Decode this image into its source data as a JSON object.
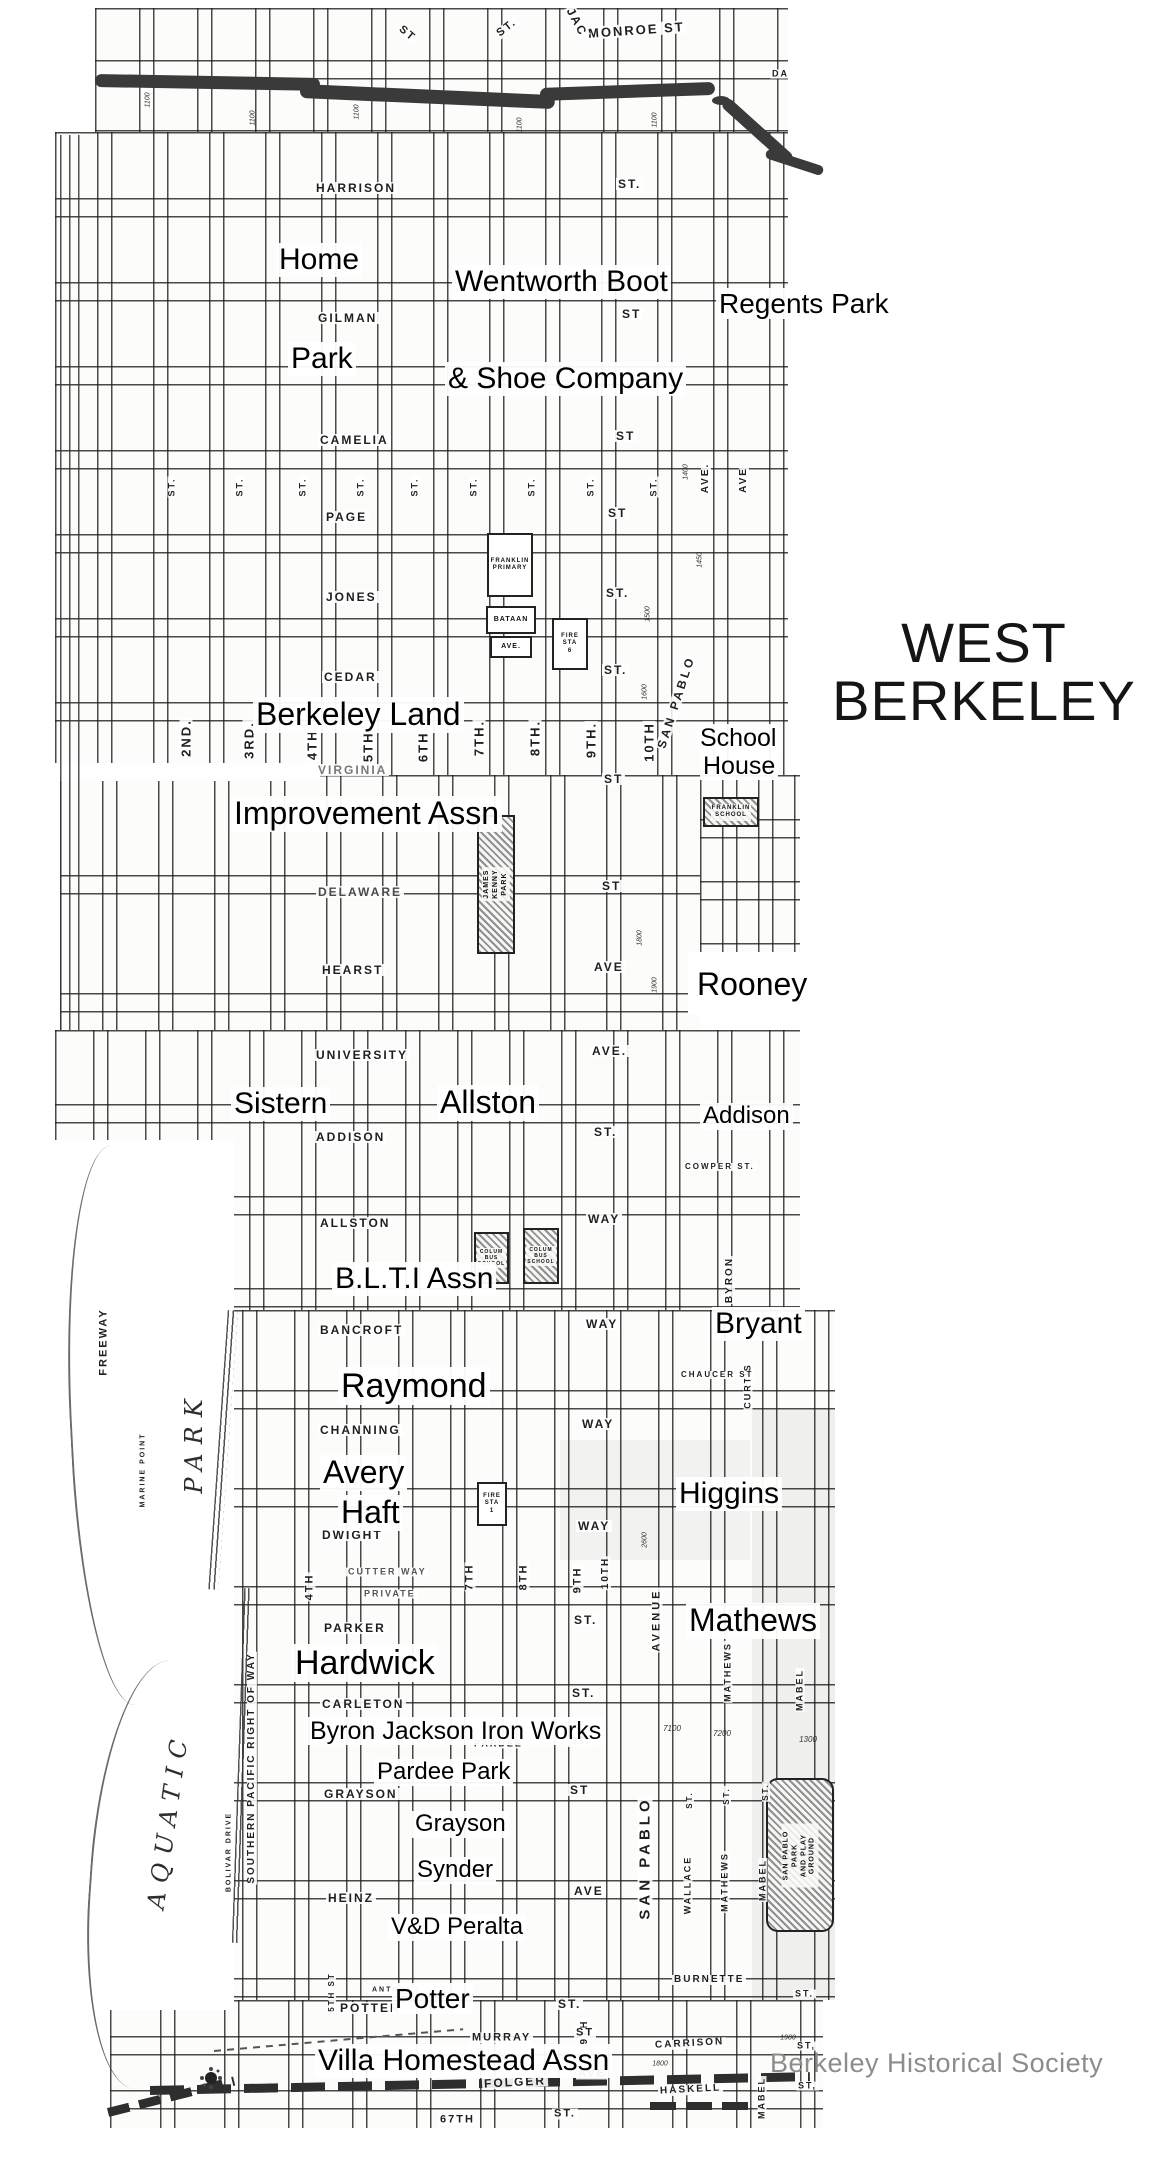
{
  "title": {
    "line1": "WEST",
    "line2": "BERKELEY"
  },
  "credit": "Berkeley Historical Society",
  "colors": {
    "ink": "#1c1c1c",
    "annotation": "#000000",
    "credit_gray": "#8c8c8c",
    "railroad": "#3a3a3a",
    "paper": "#fbfbf8"
  },
  "annotations": [
    {
      "text": "Home",
      "x": 276,
      "y": 243,
      "fs": 30
    },
    {
      "text": "Wentworth Boot",
      "x": 452,
      "y": 265,
      "fs": 30
    },
    {
      "text": "Regents Park",
      "x": 716,
      "y": 288,
      "fs": 28
    },
    {
      "text": "Park",
      "x": 288,
      "y": 342,
      "fs": 30
    },
    {
      "text": "& Shoe Company",
      "x": 445,
      "y": 362,
      "fs": 30
    },
    {
      "text": "Berkeley Land",
      "x": 253,
      "y": 697,
      "fs": 32
    },
    {
      "text": "School",
      "x": 697,
      "y": 724,
      "fs": 25
    },
    {
      "text": "House",
      "x": 700,
      "y": 752,
      "fs": 25
    },
    {
      "text": "Improvement Assn",
      "x": 231,
      "y": 796,
      "fs": 32
    },
    {
      "text": "Rooney",
      "x": 694,
      "y": 967,
      "fs": 32
    },
    {
      "text": "Sistern",
      "x": 231,
      "y": 1087,
      "fs": 30
    },
    {
      "text": "Allston",
      "x": 437,
      "y": 1085,
      "fs": 32
    },
    {
      "text": "Addison",
      "x": 700,
      "y": 1103,
      "fs": 24
    },
    {
      "text": "B.L.T.I Assn",
      "x": 332,
      "y": 1262,
      "fs": 30
    },
    {
      "text": "Bryant",
      "x": 712,
      "y": 1307,
      "fs": 30
    },
    {
      "text": "Raymond",
      "x": 338,
      "y": 1367,
      "fs": 34
    },
    {
      "text": "Avery",
      "x": 320,
      "y": 1455,
      "fs": 32
    },
    {
      "text": "Haft",
      "x": 338,
      "y": 1495,
      "fs": 32
    },
    {
      "text": "Higgins",
      "x": 676,
      "y": 1477,
      "fs": 30
    },
    {
      "text": "Mathews",
      "x": 686,
      "y": 1603,
      "fs": 32
    },
    {
      "text": "Hardwick",
      "x": 292,
      "y": 1644,
      "fs": 34
    },
    {
      "text": "Byron Jackson Iron Works",
      "x": 307,
      "y": 1717,
      "fs": 25
    },
    {
      "text": "Pardee Park",
      "x": 374,
      "y": 1759,
      "fs": 24
    },
    {
      "text": "Grayson",
      "x": 412,
      "y": 1811,
      "fs": 24
    },
    {
      "text": "Synder",
      "x": 414,
      "y": 1857,
      "fs": 24
    },
    {
      "text": "V&D Peralta",
      "x": 388,
      "y": 1914,
      "fs": 24
    },
    {
      "text": "Potter",
      "x": 392,
      "y": 1983,
      "fs": 28
    },
    {
      "text": "Villa Homestead Assn",
      "x": 315,
      "y": 2044,
      "fs": 30
    }
  ],
  "street_labels": [
    {
      "t": "MONROE ST",
      "x": 586,
      "y": 30,
      "fs": 13,
      "rot": -4
    },
    {
      "t": "JAC",
      "x": 560,
      "y": 22,
      "fs": 12,
      "rot": 62
    },
    {
      "t": "ST",
      "x": 396,
      "y": 34,
      "fs": 11,
      "rot": 40
    },
    {
      "t": "ST.",
      "x": 494,
      "y": 28,
      "fs": 11,
      "rot": -38
    },
    {
      "t": "DA",
      "x": 770,
      "y": 74,
      "fs": 9
    },
    {
      "t": "HARRISON",
      "x": 314,
      "y": 188,
      "fs": 12
    },
    {
      "t": "ST.",
      "x": 616,
      "y": 184,
      "fs": 12
    },
    {
      "t": "GILMAN",
      "x": 316,
      "y": 318,
      "fs": 12
    },
    {
      "t": "ST",
      "x": 620,
      "y": 314,
      "fs": 12
    },
    {
      "t": "CAMELIA",
      "x": 318,
      "y": 440,
      "fs": 12
    },
    {
      "t": "ST",
      "x": 614,
      "y": 436,
      "fs": 12
    },
    {
      "t": "PAGE",
      "x": 324,
      "y": 517,
      "fs": 12
    },
    {
      "t": "ST",
      "x": 606,
      "y": 513,
      "fs": 12
    },
    {
      "t": "JONES",
      "x": 324,
      "y": 597,
      "fs": 12
    },
    {
      "t": "ST.",
      "x": 604,
      "y": 593,
      "fs": 12
    },
    {
      "t": "CEDAR",
      "x": 322,
      "y": 677,
      "fs": 12
    },
    {
      "t": "ST.",
      "x": 602,
      "y": 670,
      "fs": 12
    },
    {
      "t": "VIRGINIA",
      "x": 316,
      "y": 770,
      "fs": 12,
      "c": "#787878"
    },
    {
      "t": "ST",
      "x": 602,
      "y": 779,
      "fs": 12
    },
    {
      "t": "DELAWARE",
      "x": 316,
      "y": 892,
      "fs": 12,
      "c": "#4a4a4a"
    },
    {
      "t": "ST",
      "x": 600,
      "y": 886,
      "fs": 12
    },
    {
      "t": "HEARST",
      "x": 320,
      "y": 970,
      "fs": 12
    },
    {
      "t": "AVE",
      "x": 592,
      "y": 967,
      "fs": 12
    },
    {
      "t": "UNIVERSITY",
      "x": 314,
      "y": 1055,
      "fs": 12
    },
    {
      "t": "AVE.",
      "x": 590,
      "y": 1051,
      "fs": 12
    },
    {
      "t": "ADDISON",
      "x": 314,
      "y": 1137,
      "fs": 12
    },
    {
      "t": "ST.",
      "x": 592,
      "y": 1132,
      "fs": 12
    },
    {
      "t": "ALLSTON",
      "x": 318,
      "y": 1223,
      "fs": 12
    },
    {
      "t": "WAY",
      "x": 586,
      "y": 1219,
      "fs": 12
    },
    {
      "t": "BANCROFT",
      "x": 318,
      "y": 1330,
      "fs": 12
    },
    {
      "t": "WAY",
      "x": 584,
      "y": 1324,
      "fs": 12
    },
    {
      "t": "CHANNING",
      "x": 318,
      "y": 1430,
      "fs": 12
    },
    {
      "t": "WAY",
      "x": 580,
      "y": 1424,
      "fs": 12
    },
    {
      "t": "DWIGHT",
      "x": 320,
      "y": 1535,
      "fs": 12
    },
    {
      "t": "WAY",
      "x": 576,
      "y": 1526,
      "fs": 12
    },
    {
      "t": "CUTTER WAY",
      "x": 346,
      "y": 1572,
      "fs": 9,
      "c": "#555555"
    },
    {
      "t": "PRIVATE",
      "x": 362,
      "y": 1594,
      "fs": 9,
      "c": "#555555"
    },
    {
      "t": "PARKER",
      "x": 322,
      "y": 1628,
      "fs": 12
    },
    {
      "t": "ST.",
      "x": 572,
      "y": 1620,
      "fs": 12
    },
    {
      "t": "CARLETON",
      "x": 320,
      "y": 1704,
      "fs": 12
    },
    {
      "t": "ST.",
      "x": 570,
      "y": 1693,
      "fs": 12
    },
    {
      "t": "PARDEE",
      "x": 472,
      "y": 1744,
      "fs": 9
    },
    {
      "t": "ST.",
      "x": 568,
      "y": 1742,
      "fs": 10
    },
    {
      "t": "GRAYSON",
      "x": 322,
      "y": 1794,
      "fs": 12
    },
    {
      "t": "ST",
      "x": 568,
      "y": 1790,
      "fs": 12
    },
    {
      "t": "HEINZ",
      "x": 326,
      "y": 1898,
      "fs": 12
    },
    {
      "t": "AVE",
      "x": 572,
      "y": 1891,
      "fs": 12
    },
    {
      "t": "ANTHONY",
      "x": 370,
      "y": 1990,
      "fs": 7
    },
    {
      "t": "POTTER",
      "x": 338,
      "y": 2008,
      "fs": 12
    },
    {
      "t": "ST.",
      "x": 556,
      "y": 2004,
      "fs": 12
    },
    {
      "t": "MURRAY",
      "x": 470,
      "y": 2038,
      "fs": 11
    },
    {
      "t": "ST",
      "x": 574,
      "y": 2033,
      "fs": 11
    },
    {
      "t": "AVE.",
      "x": 478,
      "y": 2058,
      "fs": 9
    },
    {
      "t": "FOLGER",
      "x": 482,
      "y": 2082,
      "fs": 12,
      "rot": -3
    },
    {
      "t": "AVE",
      "x": 576,
      "y": 2074,
      "fs": 11
    },
    {
      "t": "67TH",
      "x": 438,
      "y": 2120,
      "fs": 11
    },
    {
      "t": "ST.",
      "x": 552,
      "y": 2114,
      "fs": 11
    },
    {
      "t": "BURNETTE",
      "x": 672,
      "y": 1980,
      "fs": 10
    },
    {
      "t": "ST.",
      "x": 793,
      "y": 1994,
      "fs": 9
    },
    {
      "t": "CARRISON",
      "x": 653,
      "y": 2044,
      "fs": 10,
      "rot": -3
    },
    {
      "t": "ST,",
      "x": 795,
      "y": 2046,
      "fs": 9
    },
    {
      "t": "HASKELL",
      "x": 658,
      "y": 2090,
      "fs": 10,
      "rot": -3
    },
    {
      "t": "ST,",
      "x": 796,
      "y": 2086,
      "fs": 9
    },
    {
      "t": "CHAUCER ST",
      "x": 679,
      "y": 1375,
      "fs": 8
    },
    {
      "t": "COWPER ST.",
      "x": 683,
      "y": 1167,
      "fs": 8
    }
  ],
  "street_labels_vertical": [
    {
      "t": "2ND.",
      "x": 186,
      "y": 738,
      "fs": 13
    },
    {
      "t": "3RD.",
      "x": 249,
      "y": 740,
      "fs": 13
    },
    {
      "t": "4TH.",
      "x": 312,
      "y": 742,
      "fs": 13
    },
    {
      "t": "5TH.",
      "x": 368,
      "y": 744,
      "fs": 13
    },
    {
      "t": "6TH.",
      "x": 423,
      "y": 744,
      "fs": 13
    },
    {
      "t": "7TH.",
      "x": 479,
      "y": 738,
      "fs": 13
    },
    {
      "t": "8TH.",
      "x": 535,
      "y": 738,
      "fs": 13
    },
    {
      "t": "9TH.",
      "x": 591,
      "y": 740,
      "fs": 13
    },
    {
      "t": "10TH",
      "x": 649,
      "y": 742,
      "fs": 13
    },
    {
      "t": "SAN PABLO",
      "x": 676,
      "y": 702,
      "fs": 12,
      "rot": -72,
      "ls": 3
    },
    {
      "t": "ST.",
      "x": 172,
      "y": 487,
      "fs": 9
    },
    {
      "t": "ST.",
      "x": 240,
      "y": 487,
      "fs": 9
    },
    {
      "t": "ST.",
      "x": 303,
      "y": 487,
      "fs": 9
    },
    {
      "t": "ST.",
      "x": 361,
      "y": 487,
      "fs": 9
    },
    {
      "t": "ST.",
      "x": 415,
      "y": 487,
      "fs": 9
    },
    {
      "t": "ST.",
      "x": 474,
      "y": 487,
      "fs": 9
    },
    {
      "t": "ST.",
      "x": 532,
      "y": 487,
      "fs": 9
    },
    {
      "t": "ST.",
      "x": 591,
      "y": 487,
      "fs": 9
    },
    {
      "t": "ST.",
      "x": 654,
      "y": 487,
      "fs": 9
    },
    {
      "t": "AVE.",
      "x": 706,
      "y": 478,
      "fs": 10
    },
    {
      "t": "AVE",
      "x": 744,
      "y": 480,
      "fs": 10
    },
    {
      "t": "4TH",
      "x": 310,
      "y": 1587,
      "fs": 11
    },
    {
      "t": "7TH",
      "x": 470,
      "y": 1577,
      "fs": 11
    },
    {
      "t": "8TH",
      "x": 524,
      "y": 1577,
      "fs": 11
    },
    {
      "t": "9TH",
      "x": 578,
      "y": 1580,
      "fs": 11
    },
    {
      "t": "10TH",
      "x": 606,
      "y": 1573,
      "fs": 10
    },
    {
      "t": "5TH ST",
      "x": 332,
      "y": 1992,
      "fs": 8
    },
    {
      "t": "9TH",
      "x": 585,
      "y": 2032,
      "fs": 10
    },
    {
      "t": "BYRON",
      "x": 730,
      "y": 1280,
      "fs": 10
    },
    {
      "t": "CURTIS",
      "x": 748,
      "y": 1386,
      "fs": 9
    },
    {
      "t": "AVENUE",
      "x": 657,
      "y": 1620,
      "fs": 11,
      "ls": 3
    },
    {
      "t": "MATHEWS",
      "x": 728,
      "y": 1672,
      "fs": 9
    },
    {
      "t": "MABEL",
      "x": 800,
      "y": 1690,
      "fs": 9
    },
    {
      "t": "SAN PABLO",
      "x": 645,
      "y": 1858,
      "fs": 15,
      "ls": 4
    },
    {
      "t": "WALLACE",
      "x": 688,
      "y": 1885,
      "fs": 9
    },
    {
      "t": "MATHEWS",
      "x": 725,
      "y": 1882,
      "fs": 9
    },
    {
      "t": "MABEL",
      "x": 763,
      "y": 1880,
      "fs": 9
    },
    {
      "t": "ST.",
      "x": 690,
      "y": 1800,
      "fs": 8
    },
    {
      "t": "ST.",
      "x": 727,
      "y": 1796,
      "fs": 8
    },
    {
      "t": "ST.",
      "x": 766,
      "y": 1792,
      "fs": 8
    },
    {
      "t": "MABEL",
      "x": 762,
      "y": 2098,
      "fs": 9
    },
    {
      "t": "SOUTHERN PACIFIC RIGHT OF WAY",
      "x": 252,
      "y": 1768,
      "fs": 10,
      "ls": 2
    },
    {
      "t": "FREEWAY",
      "x": 104,
      "y": 1342,
      "fs": 11,
      "ls": 2
    },
    {
      "t": "PARK",
      "x": 194,
      "y": 1442,
      "fs": 24,
      "serif": true,
      "ls": 9
    },
    {
      "t": "AQUATIC",
      "x": 168,
      "y": 1820,
      "fs": 24,
      "serif": true,
      "ls": 9,
      "rot": -82
    },
    {
      "t": "MARINE POINT",
      "x": 143,
      "y": 1470,
      "fs": 7
    },
    {
      "t": "BOLIVAR DRIVE",
      "x": 229,
      "y": 1852,
      "fs": 7
    }
  ],
  "block_numbers": [
    {
      "t": "1100",
      "x": 148,
      "y": 100
    },
    {
      "t": "1100",
      "x": 253,
      "y": 118
    },
    {
      "t": "1100",
      "x": 357,
      "y": 112
    },
    {
      "t": "1100",
      "x": 520,
      "y": 125
    },
    {
      "t": "1100",
      "x": 655,
      "y": 120
    },
    {
      "t": "1400",
      "x": 686,
      "y": 472
    },
    {
      "t": "1450",
      "x": 700,
      "y": 560
    },
    {
      "t": "1500",
      "x": 648,
      "y": 614
    },
    {
      "t": "1600",
      "x": 645,
      "y": 692
    },
    {
      "t": "1800",
      "x": 640,
      "y": 938
    },
    {
      "t": "1900",
      "x": 655,
      "y": 985
    },
    {
      "t": "2600",
      "x": 645,
      "y": 1540
    },
    {
      "t": "7100",
      "x": 672,
      "y": 1729,
      "rot": 0,
      "fs": 8
    },
    {
      "t": "7200",
      "x": 722,
      "y": 1734,
      "rot": 0,
      "fs": 8
    },
    {
      "t": "1300",
      "x": 808,
      "y": 1740,
      "rot": 0,
      "fs": 8
    },
    {
      "t": "1000",
      "x": 488,
      "y": 2070,
      "rot": 0
    },
    {
      "t": "1800",
      "x": 660,
      "y": 2064,
      "rot": 0
    },
    {
      "t": "1900",
      "x": 788,
      "y": 2038,
      "rot": 0
    }
  ],
  "features": [
    {
      "name": "james-kenny-park",
      "x": 477,
      "y": 815,
      "w": 34,
      "h": 135,
      "hatch": true,
      "label": "JAMES KENNY PARK",
      "lfs": 7,
      "vert": true
    },
    {
      "name": "franklin-school",
      "x": 703,
      "y": 797,
      "w": 52,
      "h": 26,
      "hatch": true,
      "label": "FRANKLIN\nSCHOOL",
      "lfs": 6
    },
    {
      "name": "franklin-primary",
      "x": 487,
      "y": 533,
      "w": 42,
      "h": 60,
      "label": "FRANKLIN\nPRIMARY",
      "lfs": 6
    },
    {
      "name": "bataan-block",
      "x": 486,
      "y": 606,
      "w": 46,
      "h": 24,
      "label": "BATAAN",
      "lfs": 7
    },
    {
      "name": "ave-block",
      "x": 490,
      "y": 636,
      "w": 38,
      "h": 18,
      "label": "AVE.",
      "lfs": 7
    },
    {
      "name": "fire-station-6",
      "x": 552,
      "y": 618,
      "w": 32,
      "h": 48,
      "label": "FIRE\nSTA\n6",
      "lfs": 6
    },
    {
      "name": "fire-station-1",
      "x": 477,
      "y": 1482,
      "w": 26,
      "h": 40,
      "label": "FIRE\nSTA\n1",
      "lfs": 6
    },
    {
      "name": "columbus-school-1",
      "x": 474,
      "y": 1232,
      "w": 31,
      "h": 48,
      "hatch": true,
      "label": "COLUM\nBUS\nSCHOOL",
      "lfs": 5
    },
    {
      "name": "columbus-school-2",
      "x": 523,
      "y": 1228,
      "w": 32,
      "h": 52,
      "hatch": true,
      "label": "COLUM\nBUS\nSCHOOL",
      "lfs": 5
    },
    {
      "name": "san-pablo-park",
      "x": 766,
      "y": 1778,
      "w": 64,
      "h": 150,
      "hatch": true,
      "round": 12,
      "label": "SAN PABLO PARK\nAND PLAY GROUND",
      "lfs": 7,
      "vert": true
    }
  ],
  "map_pieces": [
    {
      "x": 95,
      "y": 8,
      "w": 693,
      "h": 124,
      "cols": 58,
      "rows": 70
    },
    {
      "x": 55,
      "y": 132,
      "w": 733,
      "h": 643,
      "cols": 56,
      "rows": 84
    },
    {
      "x": 60,
      "y": 775,
      "w": 640,
      "h": 255,
      "cols": 56,
      "rows": 118
    },
    {
      "x": 700,
      "y": 775,
      "w": 100,
      "h": 180,
      "cols": 36,
      "rows": 62
    },
    {
      "x": 55,
      "y": 1030,
      "w": 745,
      "h": 280,
      "cols": 52,
      "rows": 92
    },
    {
      "x": 48,
      "y": 1310,
      "w": 787,
      "h": 690,
      "cols": 52,
      "rows": 98
    },
    {
      "x": 110,
      "y": 2000,
      "w": 713,
      "h": 128,
      "cols": 64,
      "rows": 54
    }
  ],
  "white_regions": [
    {
      "x": 48,
      "y": 1140,
      "w": 186,
      "h": 870
    },
    {
      "x": 55,
      "y": 763,
      "w": 265,
      "h": 18
    },
    {
      "x": 688,
      "y": 952,
      "w": 140,
      "h": 62
    }
  ],
  "shades": [
    {
      "x": 752,
      "y": 1410,
      "w": 83,
      "h": 590,
      "o": 0.05
    },
    {
      "x": 560,
      "y": 1440,
      "w": 190,
      "h": 120,
      "o": 0.04
    },
    {
      "x": 120,
      "y": 1660,
      "w": 110,
      "h": 340,
      "o": 0.04
    }
  ],
  "curves": [
    {
      "x": 70,
      "y": 1145,
      "w": 110,
      "h": 560,
      "rot": -3
    },
    {
      "x": 90,
      "y": 1660,
      "w": 130,
      "h": 430,
      "rot": 4
    }
  ],
  "multilines": [
    {
      "x": 60,
      "y": 135,
      "w": 25,
      "h": 895,
      "gap": 9,
      "rot": 0
    },
    {
      "x": 238,
      "y": 1588,
      "w": 7,
      "h": 355,
      "gap": 4,
      "rot": 2
    },
    {
      "x": 218,
      "y": 1310,
      "w": 10,
      "h": 280,
      "gap": 5,
      "rot": 4
    }
  ],
  "railroad_segments": [
    {
      "x": 95,
      "y": 74,
      "w": 225,
      "h": 13,
      "rot": 1
    },
    {
      "x": 300,
      "y": 84,
      "w": 255,
      "h": 14,
      "rot": 2.5
    },
    {
      "x": 540,
      "y": 88,
      "w": 175,
      "h": 13,
      "rot": -2
    },
    {
      "x": 724,
      "y": 95,
      "w": 90,
      "h": 12,
      "rot": 42
    },
    {
      "x": 766,
      "y": 148,
      "w": 60,
      "h": 10,
      "rot": 18
    }
  ],
  "railroad_dot": {
    "x": 712,
    "y": 96,
    "r": 9
  },
  "dashed_lines": [
    {
      "x": 150,
      "y": 2086,
      "w": 660,
      "h": 9,
      "dash": 34,
      "gap": 13,
      "rot": -1.2,
      "c": "#2e2e2e"
    },
    {
      "x": 108,
      "y": 2108,
      "w": 130,
      "h": 9,
      "dash": 22,
      "gap": 10,
      "rot": -14,
      "c": "#2e2e2e"
    },
    {
      "x": 650,
      "y": 2102,
      "w": 100,
      "h": 8,
      "dash": 26,
      "gap": 10,
      "rot": 0,
      "c": "#2e2e2e"
    },
    {
      "x": 214,
      "y": 2050,
      "w": 250,
      "h": 2,
      "dash": 7,
      "gap": 6,
      "rot": -5,
      "c": "#555555"
    }
  ],
  "sun_symbol": {
    "x": 205,
    "y": 2072
  }
}
